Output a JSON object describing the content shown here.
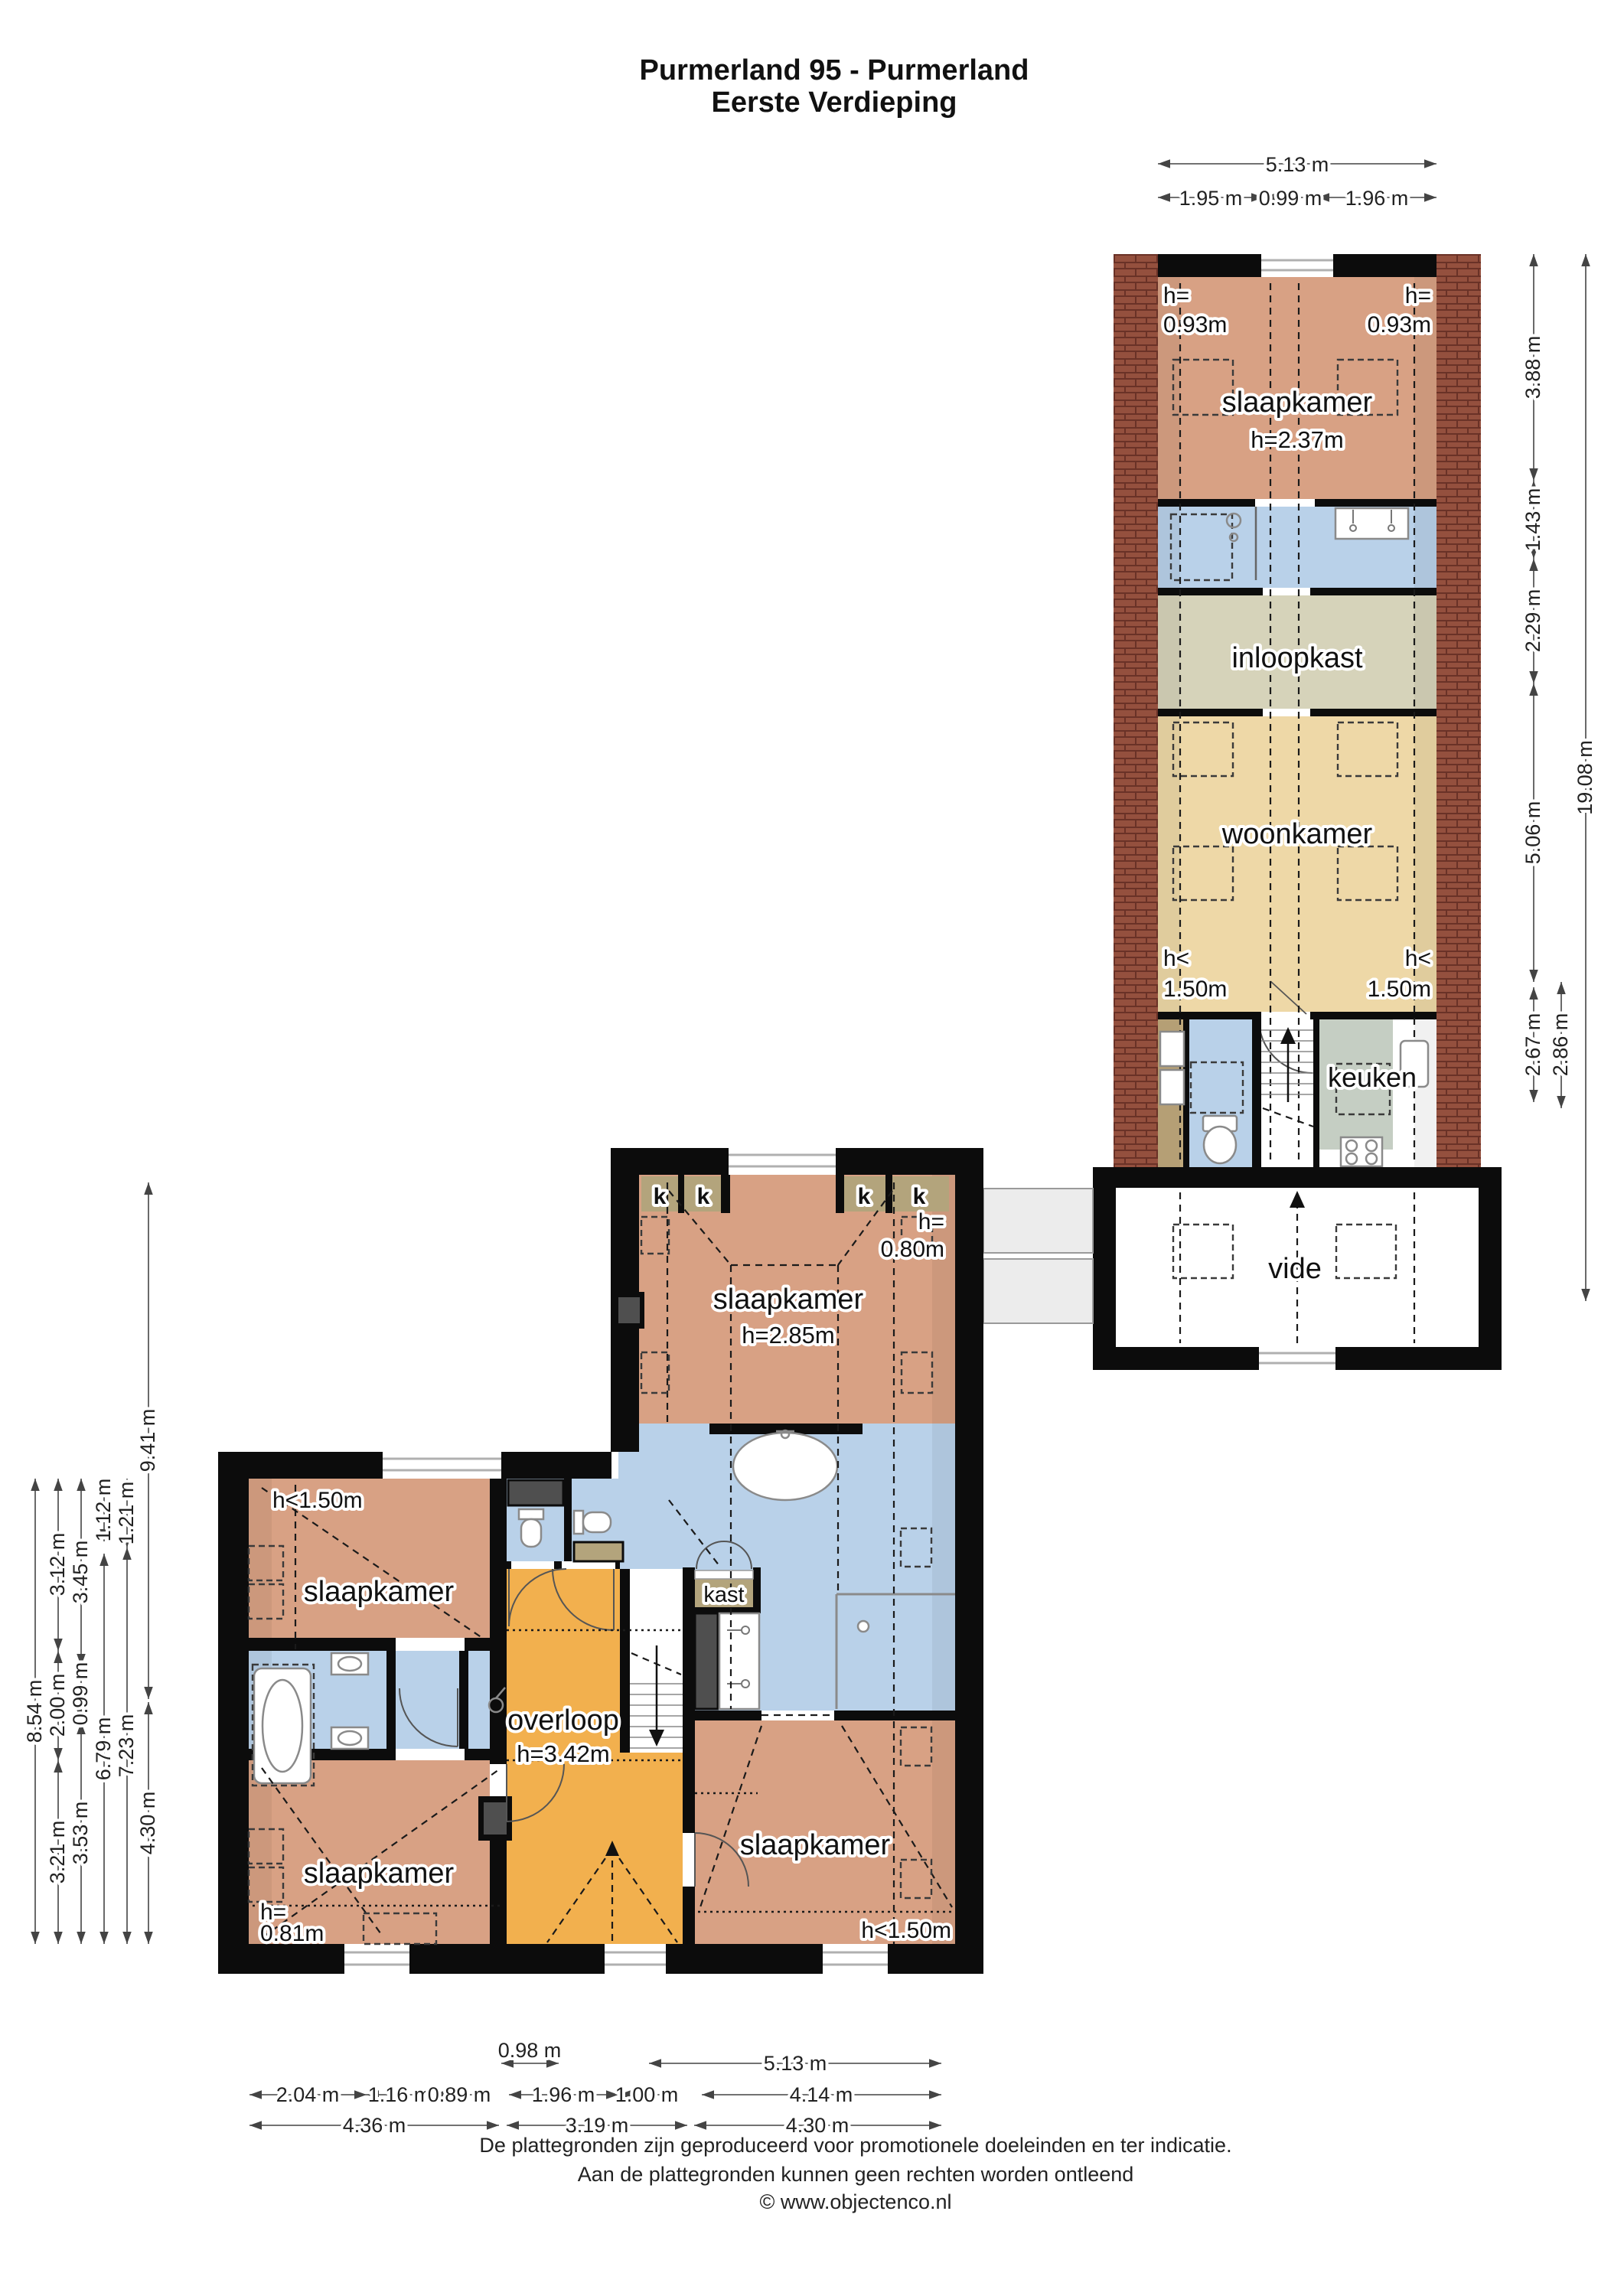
{
  "title": {
    "line1": "Purmerland 95 - Purmerland",
    "line2": "Eerste Verdieping"
  },
  "rooms": {
    "right": {
      "slaapkamer": {
        "name": "slaapkamer",
        "h": "h=2.37m"
      },
      "inloopkast": "inloopkast",
      "woonkamer": "woonkamer",
      "keuken": "keuken",
      "vide": "vide"
    },
    "left": {
      "slaapkamer_top": {
        "name": "slaapkamer",
        "h": "h=2.85m"
      },
      "slaapkamer_mid": "slaapkamer",
      "slaapkamer_bottom": "slaapkamer",
      "slaapkamer_right": "slaapkamer",
      "overloop": {
        "name": "overloop",
        "h": "h=3.42m"
      },
      "kast": "kast",
      "k": "k"
    }
  },
  "notes": {
    "h093": {
      "l1": "h=",
      "l2": "0.93m"
    },
    "h150lt": {
      "l1": "h<",
      "l2": "1.50m"
    },
    "h150": "h<1.50m",
    "h080": {
      "l1": "h=",
      "l2": "0.80m"
    },
    "h081": {
      "l1": "h=",
      "l2": "0.81m"
    }
  },
  "dims": {
    "top": [
      "5.13 m",
      "1.95 m",
      "0.99 m",
      "1.96 m"
    ],
    "right": [
      "3.88 m",
      "1.43 m",
      "2.29 m",
      "5.06 m",
      "2.67 m",
      "2.86 m",
      "19.08 m"
    ],
    "left": [
      "8.54 m",
      "3.12 m",
      "2.00 m",
      "3.21 m",
      "3.45 m",
      "0.99 m",
      "3.53 m",
      "1.12 m",
      "6.79 m",
      "1.21 m",
      "7.23 m",
      "9.41 m",
      "4.30 m"
    ],
    "bottom": [
      "0.98 m",
      "5.13 m",
      "2.04 m",
      "1.16 m",
      "0.89 m",
      "1.96 m",
      "1.00 m",
      "4.14 m",
      "4.36 m",
      "3.19 m",
      "4.30 m"
    ]
  },
  "footer": {
    "line1": "De plattegronden zijn geproduceerd voor promotionele doeleinden en ter indicatie.",
    "line2": "Aan de plattegronden kunnen geen rechten worden ontleend",
    "line3": "© www.objectenco.nl"
  },
  "colors": {
    "bedroom": "#d8a184",
    "living": "#eed8a7",
    "closet_room": "#d6d3ba",
    "bath": "#b9d1e9",
    "hall": "#f2b04e",
    "kitchen": "#c5cec3",
    "kast": "#b3a47c",
    "brick": "#94503e",
    "wall": "#0c0c0c"
  }
}
